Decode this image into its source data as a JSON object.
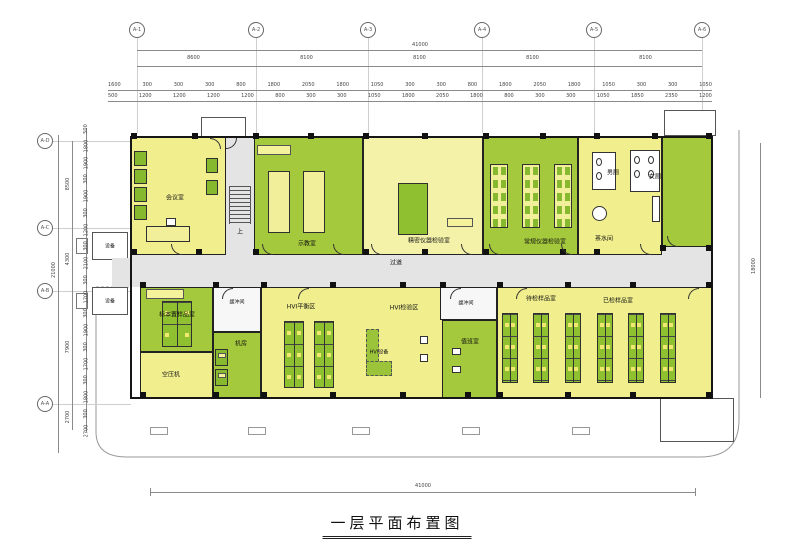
{
  "title": "一层平面布置图",
  "grid": {
    "top": [
      "A-1",
      "A-2",
      "A-3",
      "A-4",
      "A-5",
      "A-6"
    ],
    "left": [
      "A-D",
      "A-C",
      "A-B",
      "A-A"
    ]
  },
  "dimensions": {
    "total_top": "41000",
    "total_bottom": "41000",
    "right_total": "18000",
    "left_outer_total": "21000",
    "spans_top": [
      "8600",
      "8100",
      "8100",
      "8100",
      "8100"
    ],
    "detail_row1": [
      "1600",
      "300",
      "300",
      "300",
      "800",
      "1800",
      "2050",
      "1800",
      "1050",
      "300",
      "300",
      "800",
      "1800",
      "2050",
      "1800",
      "1050",
      "300",
      "300",
      "1050"
    ],
    "detail_row2": [
      "500",
      "1200",
      "1200",
      "1200",
      "1200",
      "800",
      "300",
      "300",
      "1050",
      "1800",
      "2050",
      "1800",
      "800",
      "300",
      "300",
      "1050",
      "1850",
      "2350",
      "1200"
    ],
    "left_overall": [
      "8500",
      "4300",
      "7900",
      "2700"
    ],
    "left_detail": [
      "500",
      "1800",
      "1900",
      "300",
      "1900",
      "300",
      "1200",
      "300",
      "2100",
      "300",
      "1700",
      "300",
      "1900",
      "300",
      "1700",
      "300",
      "1800",
      "300",
      "2700"
    ]
  },
  "rooms": {
    "meeting": "会议室",
    "stair_up": "上",
    "demo": "示教室",
    "instrument": "精密仪器检验室",
    "lab": "常规仪器检验室",
    "toilet_male": "男厕",
    "toilet_female": "女厕",
    "tea": "茶水间",
    "corridor": "过道",
    "equipment_a": "设备",
    "equipment_b": "设备",
    "sample_store": "标本置样品室",
    "compressor": "空压机",
    "buffer_a": "缓冲间",
    "buffer_b": "缓冲间",
    "machine": "机房",
    "hvi_balance": "HVI平衡区",
    "hvi_test": "HVI检验区",
    "hvi_equipment": "HVI设备",
    "duty": "值班室",
    "samples_pending": "待检样品室",
    "samples_checked": "已检样品室"
  },
  "colors": {
    "room_yellow": "#f1ee8d",
    "room_green": "#a5c93c",
    "room_pale": "#f4f2a9",
    "corridor_gray": "#e4e4e4",
    "furniture_green": "#86b92e",
    "wall": "#1a1a1a"
  }
}
